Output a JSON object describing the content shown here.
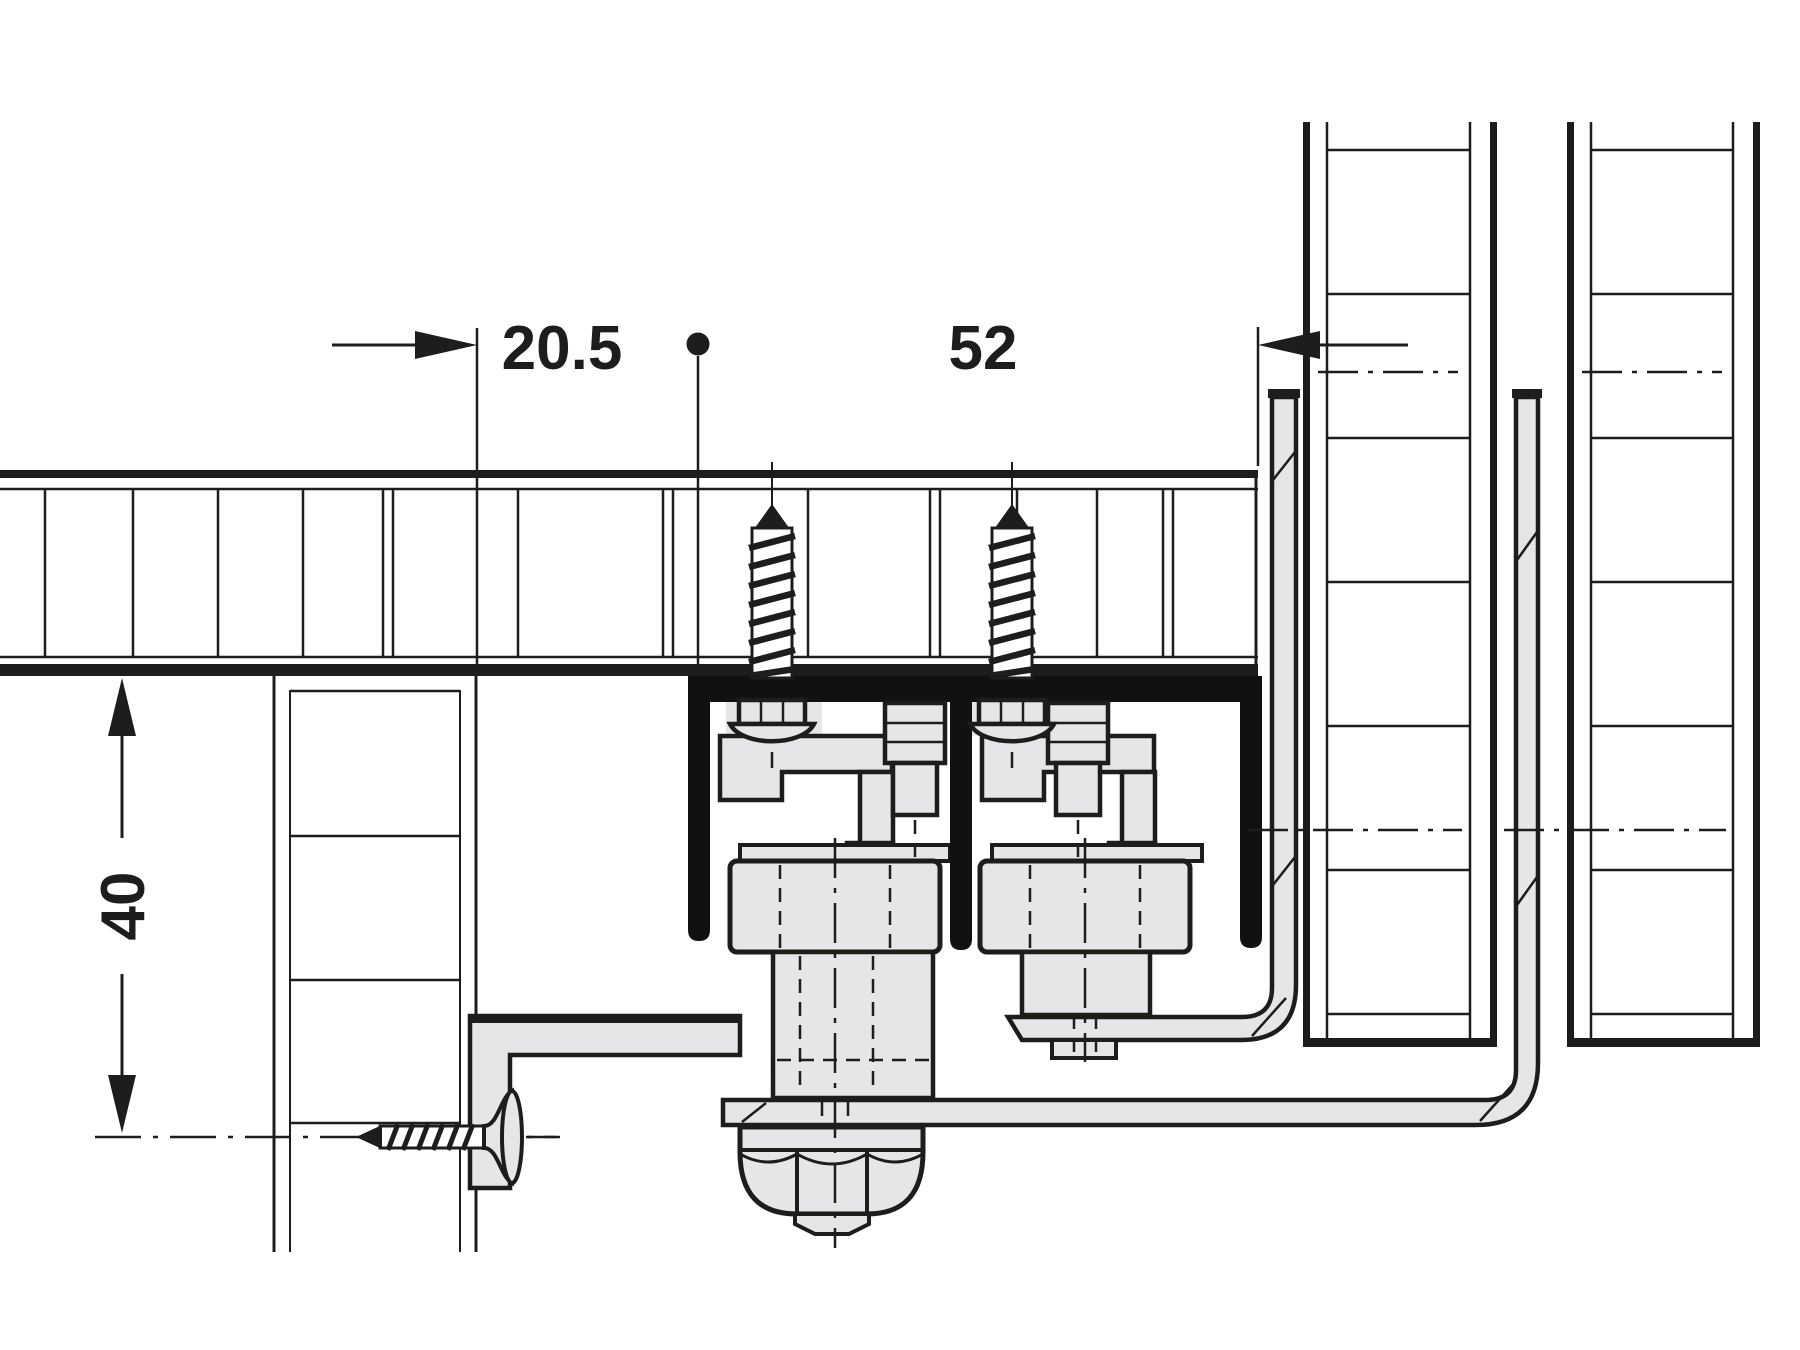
{
  "diagram": {
    "dimensions": {
      "front_offset": {
        "value": "20.5"
      },
      "center_distance": {
        "value": "52"
      },
      "bottom_offset": {
        "value": "40"
      }
    },
    "colors": {
      "line": "#1d1d1b",
      "fill_light": "#e5e6e8",
      "track_black": "#111111",
      "background": "#ffffff"
    }
  }
}
